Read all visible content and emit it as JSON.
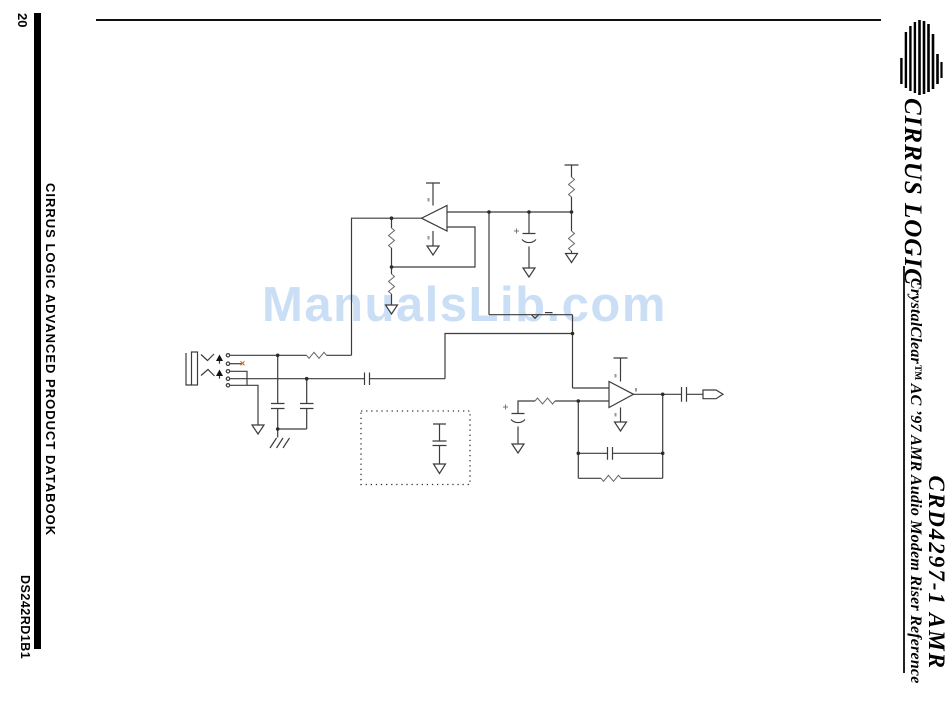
{
  "page": {
    "number": "20",
    "sidebar_text": "CIRRUS LOGIC ADVANCED PRODUCT DATABOOK",
    "doc_code": "DS242RD1B1",
    "background": "#ffffff",
    "rule_color": "#111111"
  },
  "brand": {
    "logo_icon": "cirrus-logic-striped-sphere",
    "logo_text": "CIRRUS LOGIC"
  },
  "titleblock": {
    "product": "CRD4297-1 AMR",
    "description": "CrystalClear™ AC ’97 AMR Audio Modem Riser Reference"
  },
  "watermark": {
    "text": "ManualsLib.com",
    "color": "#cadef6"
  },
  "figure": {
    "type": "circuit-schematic",
    "ink_color": "#3c3c3c",
    "marker_color": "#c0763a",
    "components": [
      "audio-jack-connector",
      "op-amp-left-facing",
      "op-amp-right-facing",
      "resistors",
      "series-capacitors",
      "polarized-capacitors",
      "ground-symbols",
      "chassis-ground",
      "power-rail-bars",
      "output-port",
      "dotted-option-box-with-capacitor"
    ]
  }
}
